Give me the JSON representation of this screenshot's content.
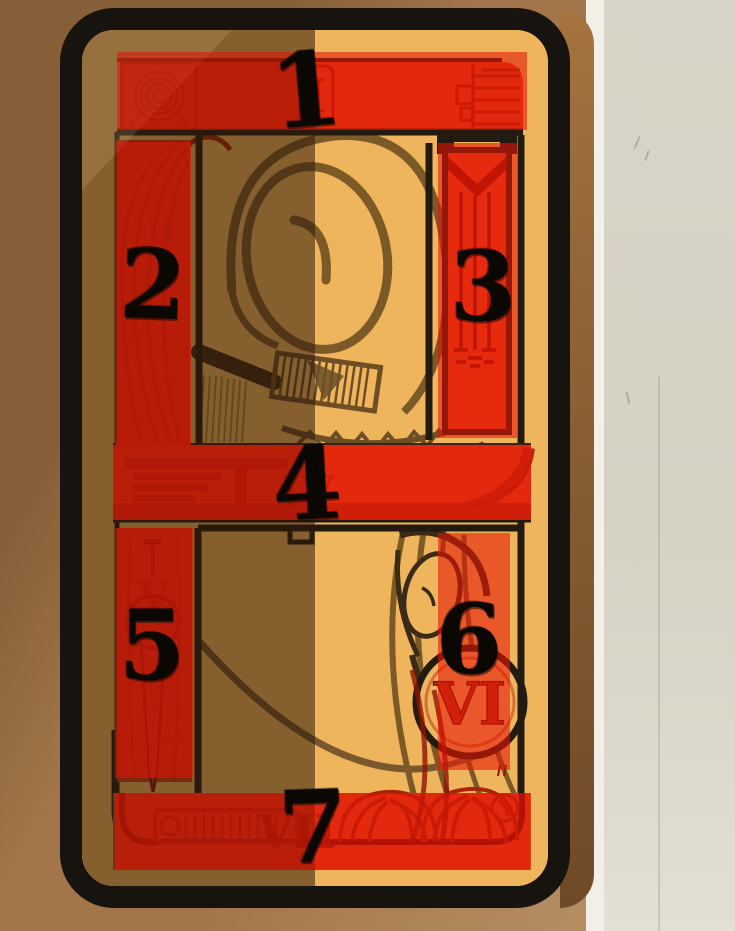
{
  "scene": {
    "description": "Tarot-style game card with seven numbered annotation overlays",
    "card": {
      "numerals": {
        "top_banner": "I",
        "left_upper_column": "II",
        "middle_banner": "IV",
        "left_lower_column": "V",
        "right_lower_emblem": "VI",
        "bottom_banner": "VII"
      }
    }
  },
  "annotations": {
    "overlay_color": "#e61405",
    "overlay_opacity": 0.58,
    "label_color": "#0b0703",
    "regions": [
      {
        "id": 1,
        "label": "1",
        "box": {
          "x": 117,
          "y": 52,
          "w": 410,
          "h": 78
        },
        "digit": {
          "x": 306,
          "y": 95,
          "rot": -5,
          "size": 102
        }
      },
      {
        "id": 2,
        "label": "2",
        "box": {
          "x": 115,
          "y": 142,
          "w": 76,
          "h": 303
        },
        "digit": {
          "x": 153,
          "y": 289,
          "rot": 2,
          "size": 96
        }
      },
      {
        "id": 3,
        "label": "3",
        "box": {
          "x": 438,
          "y": 143,
          "w": 79,
          "h": 295
        },
        "digit": {
          "x": 483,
          "y": 291,
          "rot": 0,
          "size": 96
        }
      },
      {
        "id": 4,
        "label": "4",
        "box": {
          "x": 113,
          "y": 445,
          "w": 418,
          "h": 75
        },
        "digit": {
          "x": 307,
          "y": 488,
          "rot": -3,
          "size": 100
        }
      },
      {
        "id": 5,
        "label": "5",
        "box": {
          "x": 115,
          "y": 528,
          "w": 78,
          "h": 250
        },
        "digit": {
          "x": 152,
          "y": 650,
          "rot": 0,
          "size": 96
        }
      },
      {
        "id": 6,
        "label": "6",
        "box": {
          "x": 438,
          "y": 533,
          "w": 72,
          "h": 237
        },
        "digit": {
          "x": 469,
          "y": 644,
          "rot": 0,
          "size": 96
        }
      },
      {
        "id": 7,
        "label": "7",
        "box": {
          "x": 115,
          "y": 793,
          "w": 415,
          "h": 77
        },
        "digit": {
          "x": 313,
          "y": 831,
          "rot": -2,
          "size": 100
        }
      }
    ]
  },
  "colors": {
    "card_border": "#17130e",
    "card_face": "#efb55c",
    "card_shadow_half": "#7b5836",
    "art_red": "#dd4518",
    "art_red_dark": "#a82408",
    "wall_left_brown": "#a2764a",
    "wall_right_gray": "#d5d1c3",
    "wall_corner_white": "#f2efe8"
  }
}
